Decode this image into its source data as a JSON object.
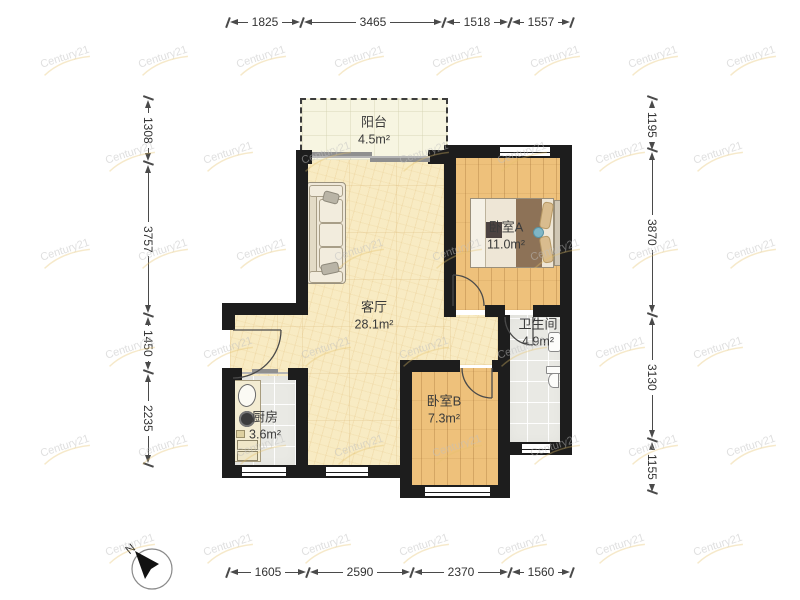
{
  "watermark": {
    "text": "Century21"
  },
  "compass": {
    "label": "N"
  },
  "rooms": {
    "balcony": {
      "name": "阳台",
      "area": "4.5m²"
    },
    "living": {
      "name": "客厅",
      "area": "28.1m²"
    },
    "bedroom_a": {
      "name": "卧室A",
      "area": "11.0m²"
    },
    "bedroom_b": {
      "name": "卧室B",
      "area": "7.3m²"
    },
    "bathroom": {
      "name": "卫生间",
      "area": "4.9m²"
    },
    "kitchen": {
      "name": "厨房",
      "area": "3.6m²"
    }
  },
  "dimensions_mm": {
    "top": [
      "1825",
      "3465",
      "1518",
      "1557"
    ],
    "bottom": [
      "1605",
      "2590",
      "2370",
      "1560"
    ],
    "left": [
      "1308",
      "3757",
      "1450",
      "2235"
    ],
    "right": [
      "1195",
      "3870",
      "3130",
      "1155"
    ]
  }
}
